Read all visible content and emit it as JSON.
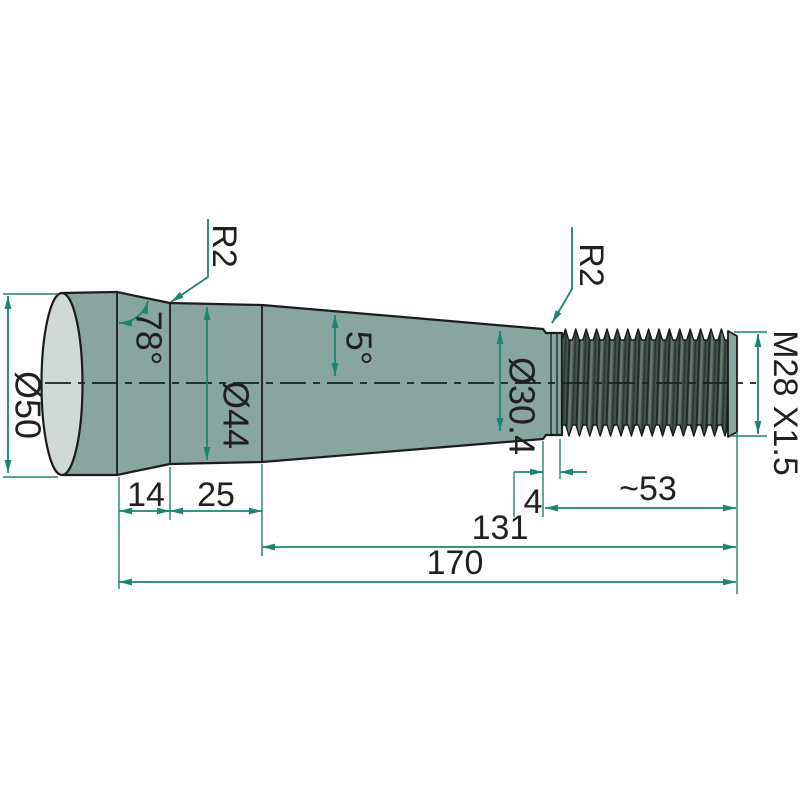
{
  "drawing": {
    "colors": {
      "body": "#88a5a0",
      "body_highlight": "#cfdad6",
      "thread_dark": "#3d4a46",
      "dimension_accent": "#1b8571",
      "outline": "#1c1c1c"
    },
    "dims": {
      "diameter_50": "Ø50",
      "angle_78": "78°",
      "radius_left": "R2",
      "diameter_44": "Ø44",
      "angle_5": "5°",
      "diameter_304": "Ø30.4",
      "radius_right": "R2",
      "thread_spec": "M28 X1.5",
      "len_14": "14",
      "len_25": "25",
      "len_4": "4",
      "len_53": "~53",
      "len_131": "131",
      "len_170": "170"
    }
  }
}
